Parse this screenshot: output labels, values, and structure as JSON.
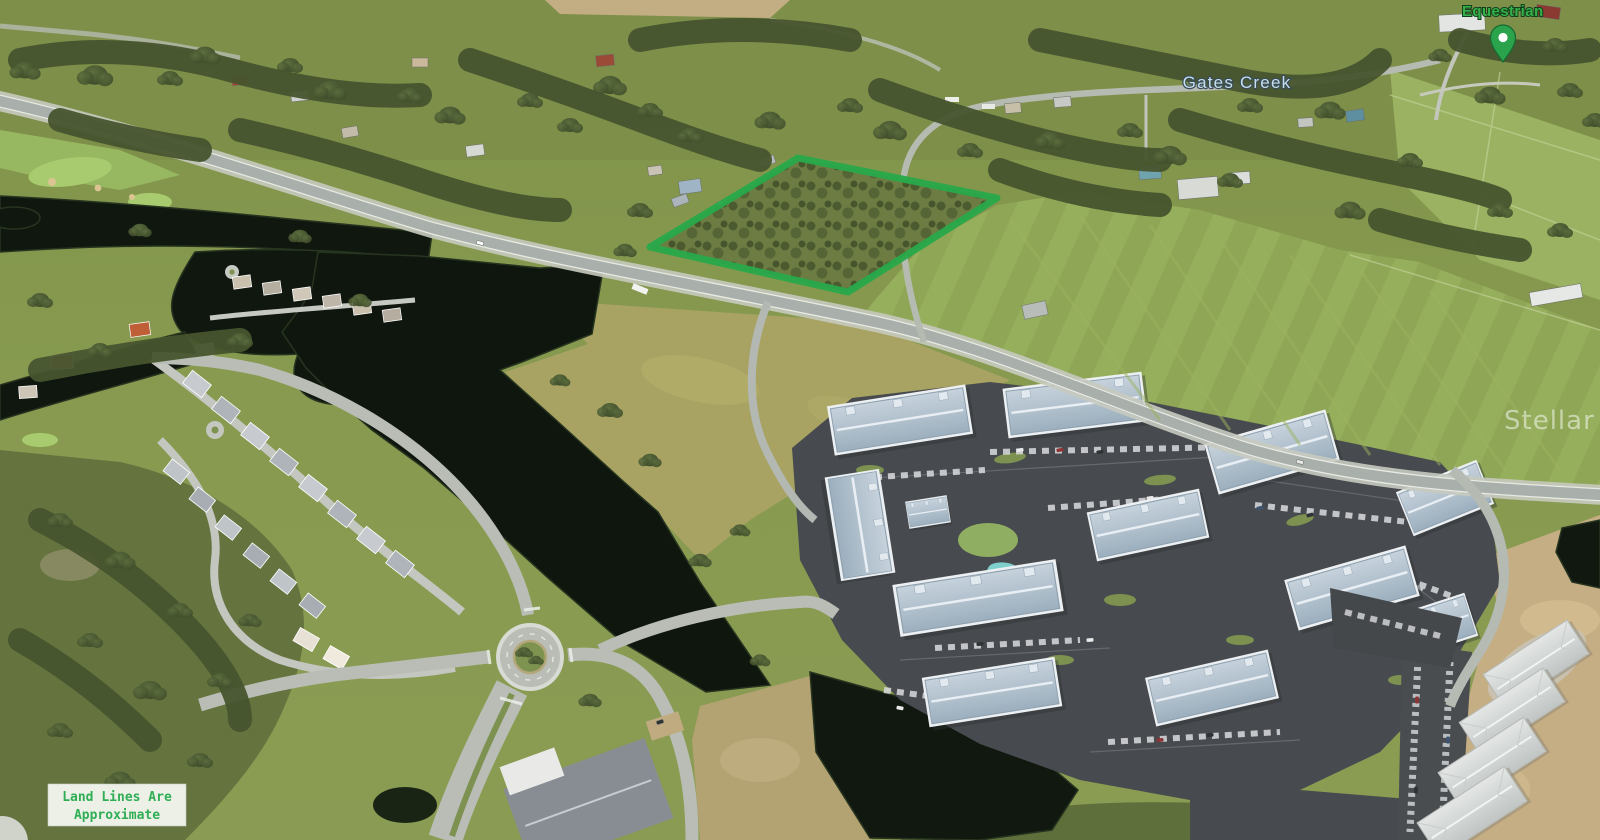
{
  "scene": {
    "description": "Oblique aerial photo of rural land and new development: outlined vacant wooded parcel, ponds, townhomes, large apartment complex, roundabout"
  },
  "labels": {
    "equestrian": {
      "text": "Equestrian",
      "color": "#35b04a"
    },
    "gates_creek": {
      "text": "Gates Creek",
      "color": "#c6dfec"
    }
  },
  "parcel_outline": {
    "points": "798,158 997,198 848,292 650,247",
    "color": "#29a94b"
  },
  "location_pin": {
    "transform": "translate(1503,62)",
    "color": "#2ba24c"
  },
  "watermark": {
    "text": "Stellar MLS",
    "color": "rgba(255,255,255,0.5)"
  },
  "disclaimer": {
    "line1": "Land Lines Are",
    "line2": "Approximate",
    "text_color": "#2fae55",
    "background": "#f7faf4"
  }
}
